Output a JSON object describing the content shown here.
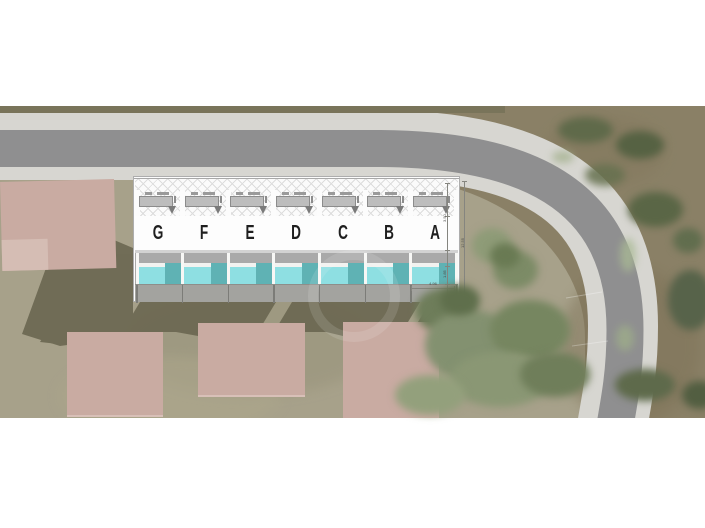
{
  "plan": {
    "unit_labels": [
      "G",
      "F",
      "E",
      "D",
      "C",
      "B",
      "A"
    ],
    "dim_width": "4.96",
    "dim_height_total": "12.55",
    "dim_seg_upper": "3.50",
    "dim_seg_lower": "1.85"
  },
  "colors": {
    "pool_light": "#8edfe2",
    "pool_dark": "#5fb2b4",
    "terrace_gray": "#a9a9a9",
    "asphalt": "#8f8f90",
    "sidewalk": "#d7d6d1",
    "ground_base": "#8a8066",
    "ground_inner": "#a7a18a",
    "building_pink": "#c9aba2",
    "shadow_olive": "#6b6751",
    "tree_sage": "#839170",
    "tree_dark": "#5d6847"
  }
}
